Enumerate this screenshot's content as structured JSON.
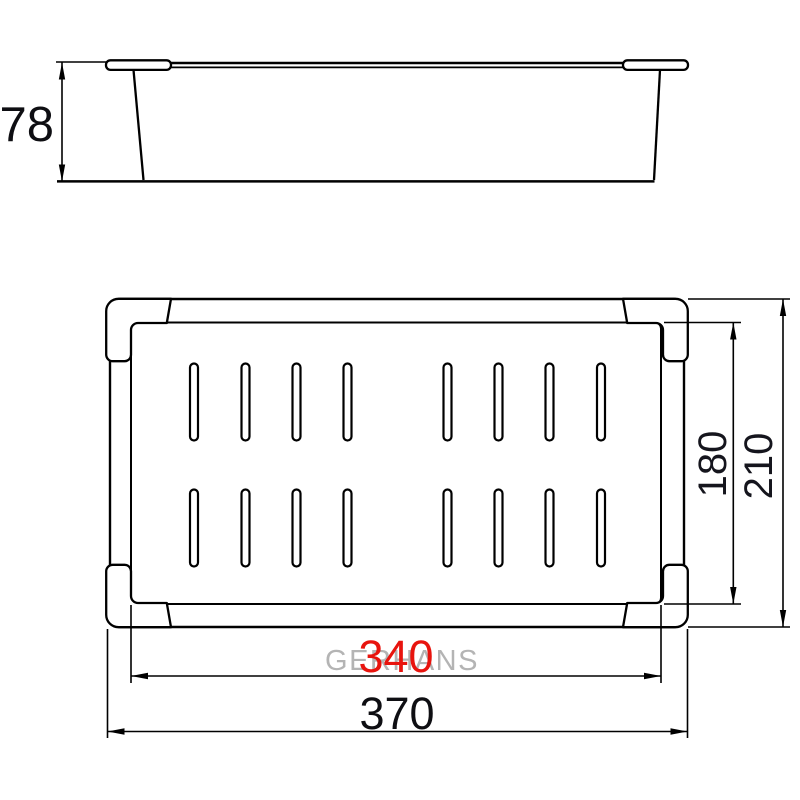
{
  "drawing": {
    "type": "technical-dimension-drawing",
    "product": "perforated colander tray (two orthographic views)",
    "background_color": "#ffffff",
    "line_color": "#000000",
    "watermark": {
      "text": "GERHANS",
      "color": "#b4b4b4"
    },
    "side_view": {
      "name": "side elevation",
      "dim_height": {
        "value": "78",
        "color": "#0e0e12"
      }
    },
    "plan_view": {
      "name": "top plan view",
      "slot_rows": 2,
      "slots_per_row": 8,
      "dim_inner_length": {
        "value": "340",
        "color": "#e8140e"
      },
      "dim_outer_length": {
        "value": "370",
        "color": "#0e0e12"
      },
      "dim_inner_width": {
        "value": "180",
        "color": "#15151d"
      },
      "dim_outer_width": {
        "value": "210",
        "color": "#15151d"
      }
    }
  }
}
